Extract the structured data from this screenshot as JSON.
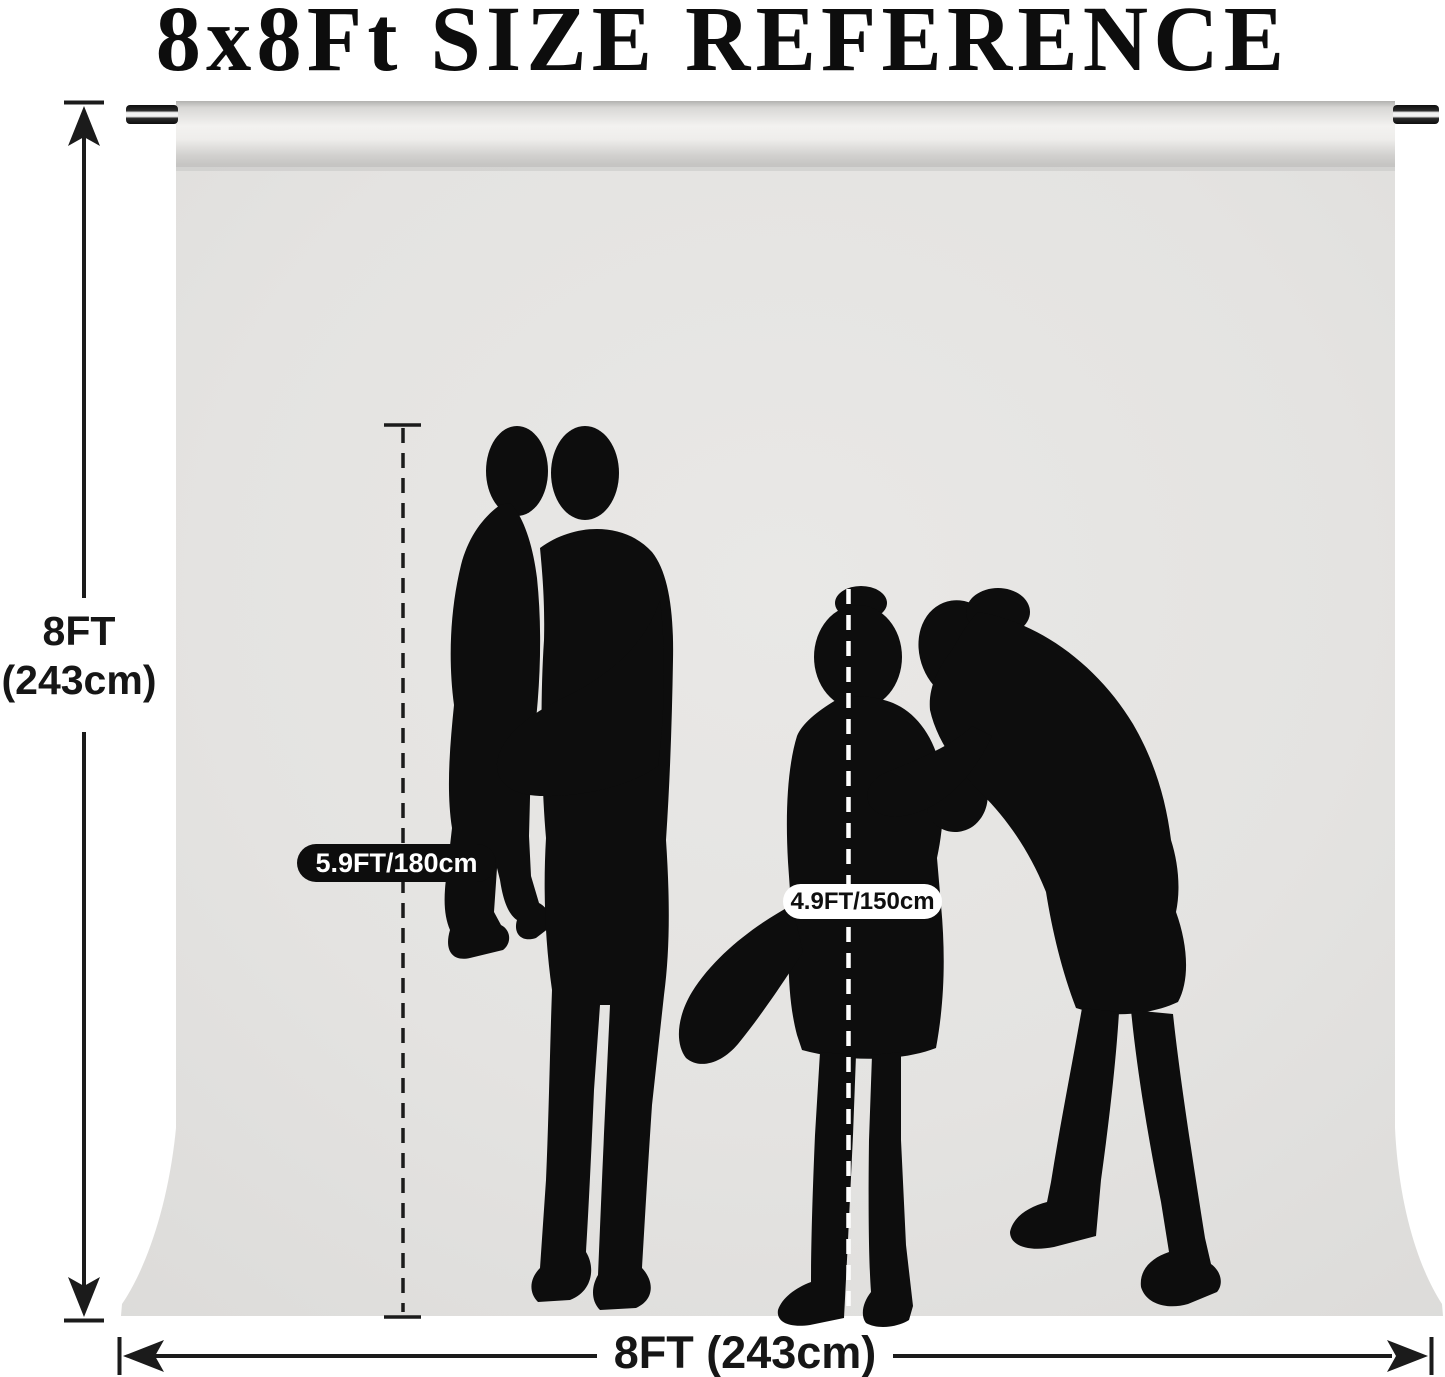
{
  "title": "8x8Ft SIZE REFERENCE",
  "height_dimension": {
    "line1": "8FT",
    "line2": "(243cm)"
  },
  "width_dimension": {
    "label": "8FT (243cm)"
  },
  "figure_heights": {
    "adult": "5.9FT/180cm",
    "child": "4.9FT/150cm"
  },
  "figures": [
    "boy-carried-silhouette",
    "man-silhouette",
    "girl-silhouette",
    "woman-silhouette"
  ],
  "colors": {
    "page_background": "#ffffff",
    "backdrop_gray": "#e3e2e1",
    "pocket_highlight": "#f3f2f0",
    "silhouette_black": "#0d0d0d",
    "line_black": "#1b1b1b",
    "badge_dark_bg": "#0d0d0d",
    "badge_dark_text": "#ffffff",
    "badge_light_bg": "#ffffff",
    "badge_light_text": "#0f0f0f"
  }
}
